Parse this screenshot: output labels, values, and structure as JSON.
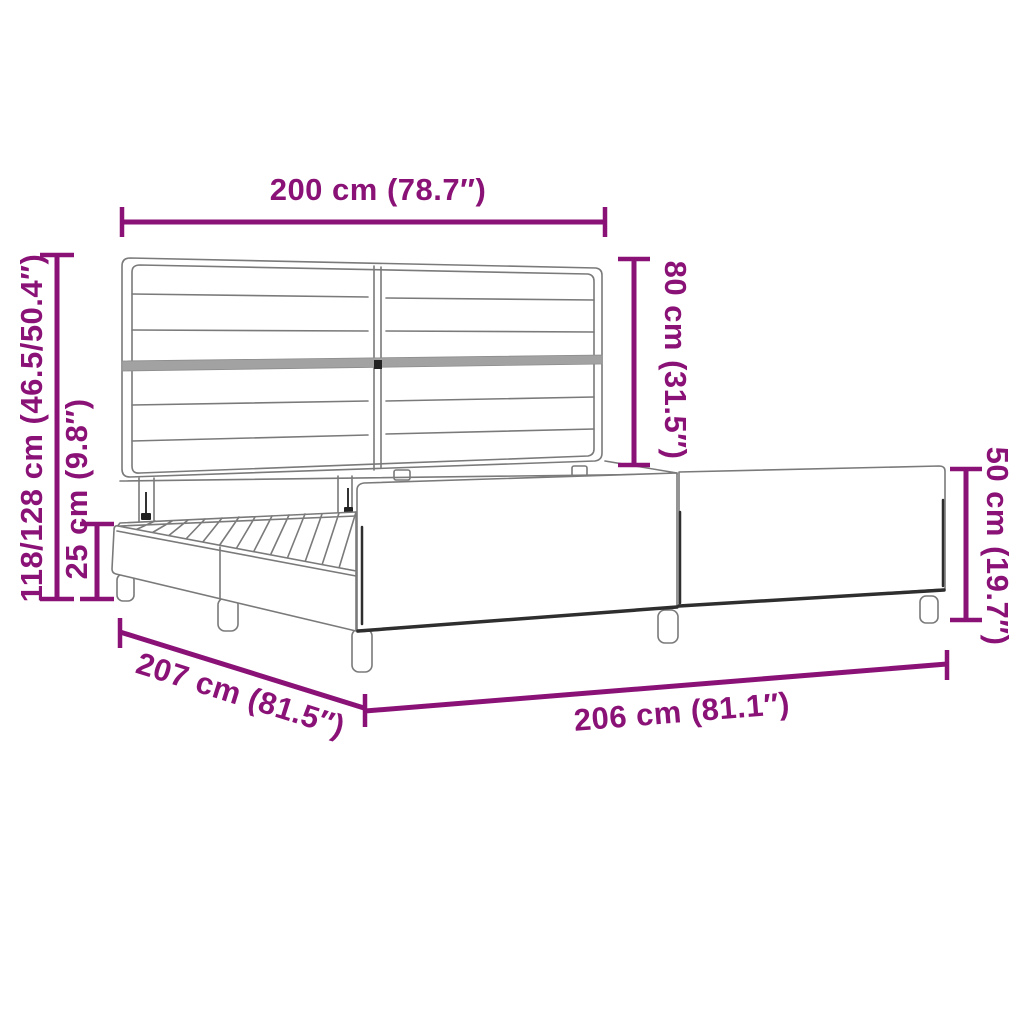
{
  "image": {
    "description": "Bed frame with headboard - product dimensions line drawing",
    "background": "#ffffff"
  },
  "colors": {
    "accent": "#8A1277",
    "line_art": "#7a7a7a"
  },
  "dimensions": {
    "headboard_width": {
      "label": "200 cm (78.7″)",
      "value_cm": "200",
      "value_in": "78.7"
    },
    "headboard_height": {
      "label": "80 cm (31.5″)",
      "value_cm": "80",
      "value_in": "31.5"
    },
    "total_height": {
      "label": "118/128 cm (46.5/50.4″)",
      "value_cm": "118/128",
      "value_in": "46.5/50.4"
    },
    "base_height": {
      "label": "25 cm (9.8″)",
      "value_cm": "25",
      "value_in": "9.8"
    },
    "side_rail_height": {
      "label": "50 cm (19.7″)",
      "value_cm": "50",
      "value_in": "19.7"
    },
    "frame_length": {
      "label": "207 cm (81.5″)",
      "value_cm": "207",
      "value_in": "81.5"
    },
    "frame_width": {
      "label": "206 cm (81.1″)",
      "value_cm": "206",
      "value_in": "81.1"
    }
  }
}
